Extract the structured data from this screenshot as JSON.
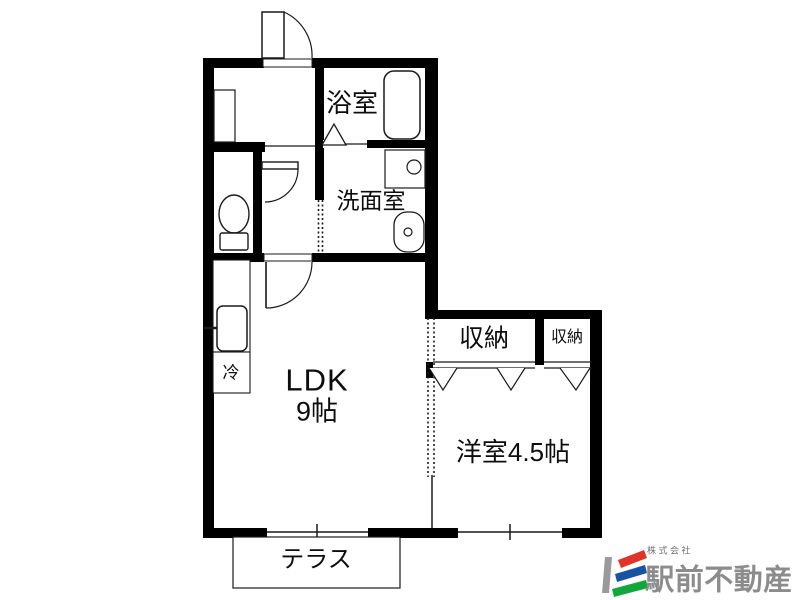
{
  "page": {
    "background": "#ffffff"
  },
  "floorplan": {
    "wall_color": "#000000",
    "line_color": "#1a1a1a",
    "labels": {
      "bath": "浴室",
      "washroom": "洗面室",
      "ldk_title": "LDK",
      "ldk_size": "9帖",
      "fridge": "冷",
      "closet_large": "収納",
      "closet_small": "収納",
      "western_room": "洋室4.5帖",
      "terrace": "テラス"
    }
  },
  "logo": {
    "company_prefix": "株式会社",
    "company_name": "駅前不動産",
    "text_color": "#8c8c8c",
    "mark_colors": {
      "gray": "#9a9a9a",
      "red": "#e0332a",
      "blue": "#1753a2",
      "green": "#12a73b"
    }
  }
}
